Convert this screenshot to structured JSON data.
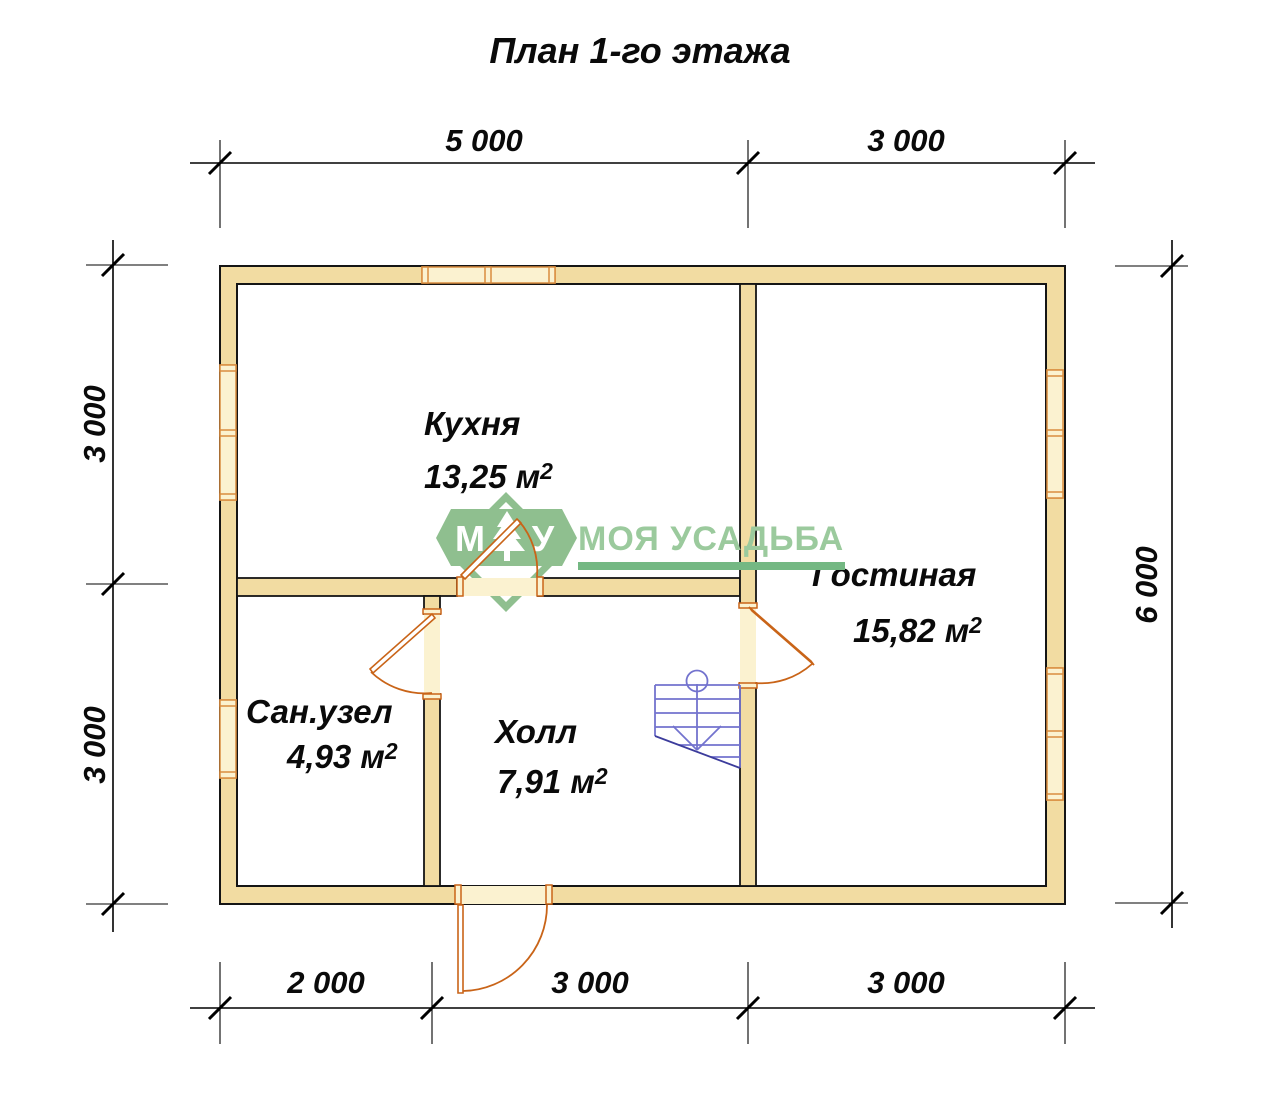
{
  "title": "План 1-го этажа",
  "logo": {
    "letter_left": "М",
    "letter_right": "У",
    "tree_icon": "fir-tree-icon",
    "brand": "МОЯ УСАДЬБА"
  },
  "dimensions": {
    "top": [
      "5 000",
      "3 000"
    ],
    "bottom": [
      "2 000",
      "3 000",
      "3 000"
    ],
    "left": [
      "3 000",
      "3 000"
    ],
    "right": [
      "6 000"
    ]
  },
  "rooms": [
    {
      "name": "Кухня",
      "area": "13,25 м",
      "sup": "2"
    },
    {
      "name": "Гостиная",
      "area": "15,82 м",
      "sup": "2"
    },
    {
      "name": "Сан.узел",
      "area": "4,93 м",
      "sup": "2"
    },
    {
      "name": "Холл",
      "area": "7,91 м",
      "sup": "2"
    }
  ],
  "colors": {
    "wall": "#F2DCA2",
    "outline": "#151515",
    "window": "#FBF2D0",
    "frame_door": "#C96418",
    "frame_window": "#D98C3F",
    "stairs": "#7373CE",
    "stairs_dark": "#3C3C9C",
    "logo_green": "#8FBF8F",
    "brand_green": "#9BCA9D",
    "underline_green": "#74B883",
    "dim": "#000000"
  }
}
